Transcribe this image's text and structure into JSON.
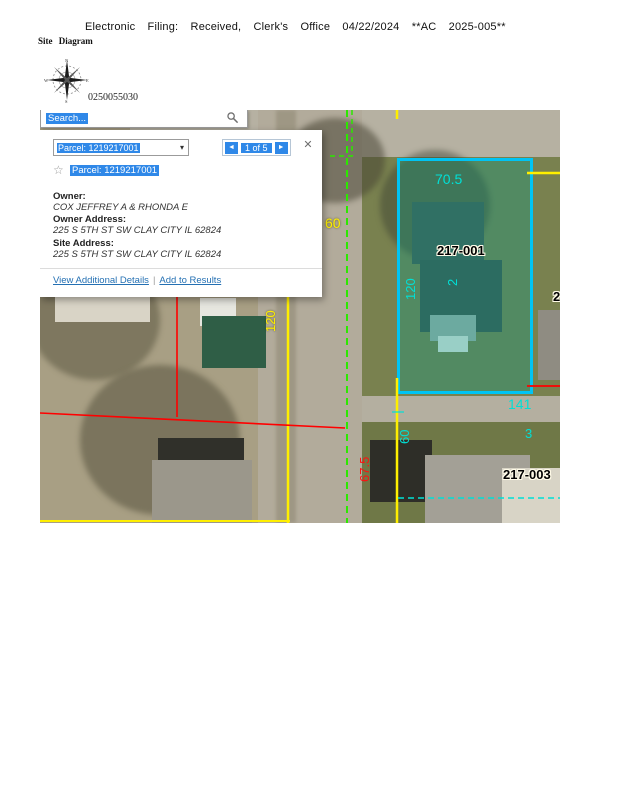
{
  "page": {
    "filing_line": "Electronic Filing: Received, Clerk's Office 04/22/2024 **AC 2025-005**",
    "site_diagram_label": "Site Diagram",
    "parcel_pin": "0250055030"
  },
  "compass": {
    "n": "N",
    "e": "E",
    "s": "S",
    "w": "W"
  },
  "map": {
    "search": {
      "value": "Search..."
    },
    "popup": {
      "dropdown_value": "Parcel: 1219217001",
      "dropdown_caret": "▾",
      "prev_icon": "◄",
      "page_status": "1 of 5",
      "next_icon": "►",
      "close_icon": "✕",
      "star_icon": "☆",
      "selected_result": "Parcel: 1219217001",
      "owner_label": "Owner:",
      "owner_value": "COX JEFFREY A & RHONDA E",
      "owner_address_label": "Owner Address:",
      "owner_address_value": "225 S 5TH ST SW CLAY CITY IL 62824",
      "site_address_label": "Site Address:",
      "site_address_value": "225 S 5TH ST SW CLAY CITY IL 62824",
      "view_details_link": "View Additional Details",
      "link_separator": "|",
      "add_results_link": "Add to Results"
    },
    "annotations": {
      "road_width_top": "60",
      "west_lot_depth": "120",
      "parcel_frontage": "70.5",
      "parcel_id": "217-001",
      "parcel_depth": "120",
      "parcel_lot_number": "2",
      "south_frontage": "141",
      "south_lot_number": "3",
      "south_road_width": "60",
      "west_frontage": "67.5",
      "south_parcel_id": "217-003",
      "east_parcel_partial": "2"
    },
    "colors": {
      "parcel_highlight_border": "#00c4f4",
      "parcel_highlight_fill": "rgba(0,160,140,0.32)",
      "dimension_cyan": "#00e0d6",
      "dimension_yellow": "#ffef00",
      "parcel_line_red": "#ff0000",
      "centerline_green": "#2ce800",
      "selection_blue": "#2f88e8",
      "link_blue": "#2470b3"
    }
  }
}
